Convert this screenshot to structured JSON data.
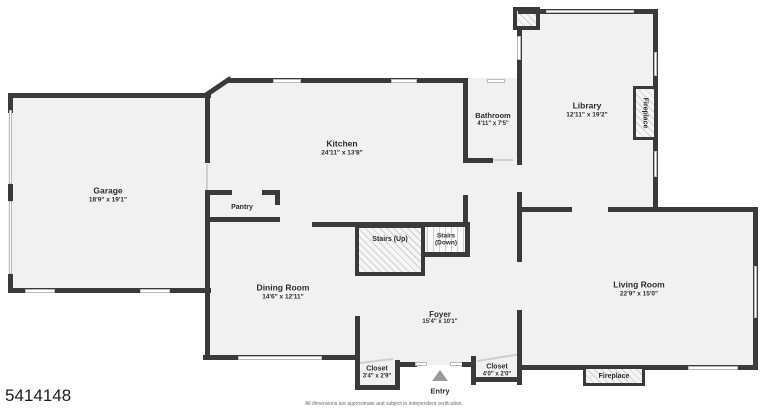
{
  "meta": {
    "listing_number": "5414148",
    "disclaimer": "All dimensions are approximate and subject to independent verification."
  },
  "rooms": {
    "garage": {
      "name": "Garage",
      "dims": "18'9\" x 19'1\""
    },
    "kitchen": {
      "name": "Kitchen",
      "dims": "24'11\" x 13'8\""
    },
    "bathroom": {
      "name": "Bathroom",
      "dims": "4'11\" x 7'5\""
    },
    "library": {
      "name": "Library",
      "dims": "12'11\" x 19'2\""
    },
    "pantry": {
      "name": "Pantry"
    },
    "dining_room": {
      "name": "Dining Room",
      "dims": "14'6\" x 12'11\""
    },
    "living_room": {
      "name": "Living Room",
      "dims": "22'9\" x 15'0\""
    },
    "foyer": {
      "name": "Foyer",
      "dims": "15'4\" x 10'1\""
    },
    "closet_left": {
      "name": "Closet",
      "dims": "3'4\" x 2'9\""
    },
    "closet_right": {
      "name": "Closet",
      "dims": "4'0\" x 2'0\""
    }
  },
  "features": {
    "stairs_up": "Stairs (Up)",
    "stairs_down_line1": "Stairs",
    "stairs_down_line2": "(Down)",
    "entry": "Entry",
    "fireplace_library": "Fireplace",
    "fireplace_living": "Fireplace"
  },
  "colors": {
    "wall": "#3a3a3c",
    "floor": "#f1f1f2",
    "window_border": "#b9b9bb",
    "entry_arrow": "#9b9b9d",
    "text": "#2d2d2f"
  }
}
